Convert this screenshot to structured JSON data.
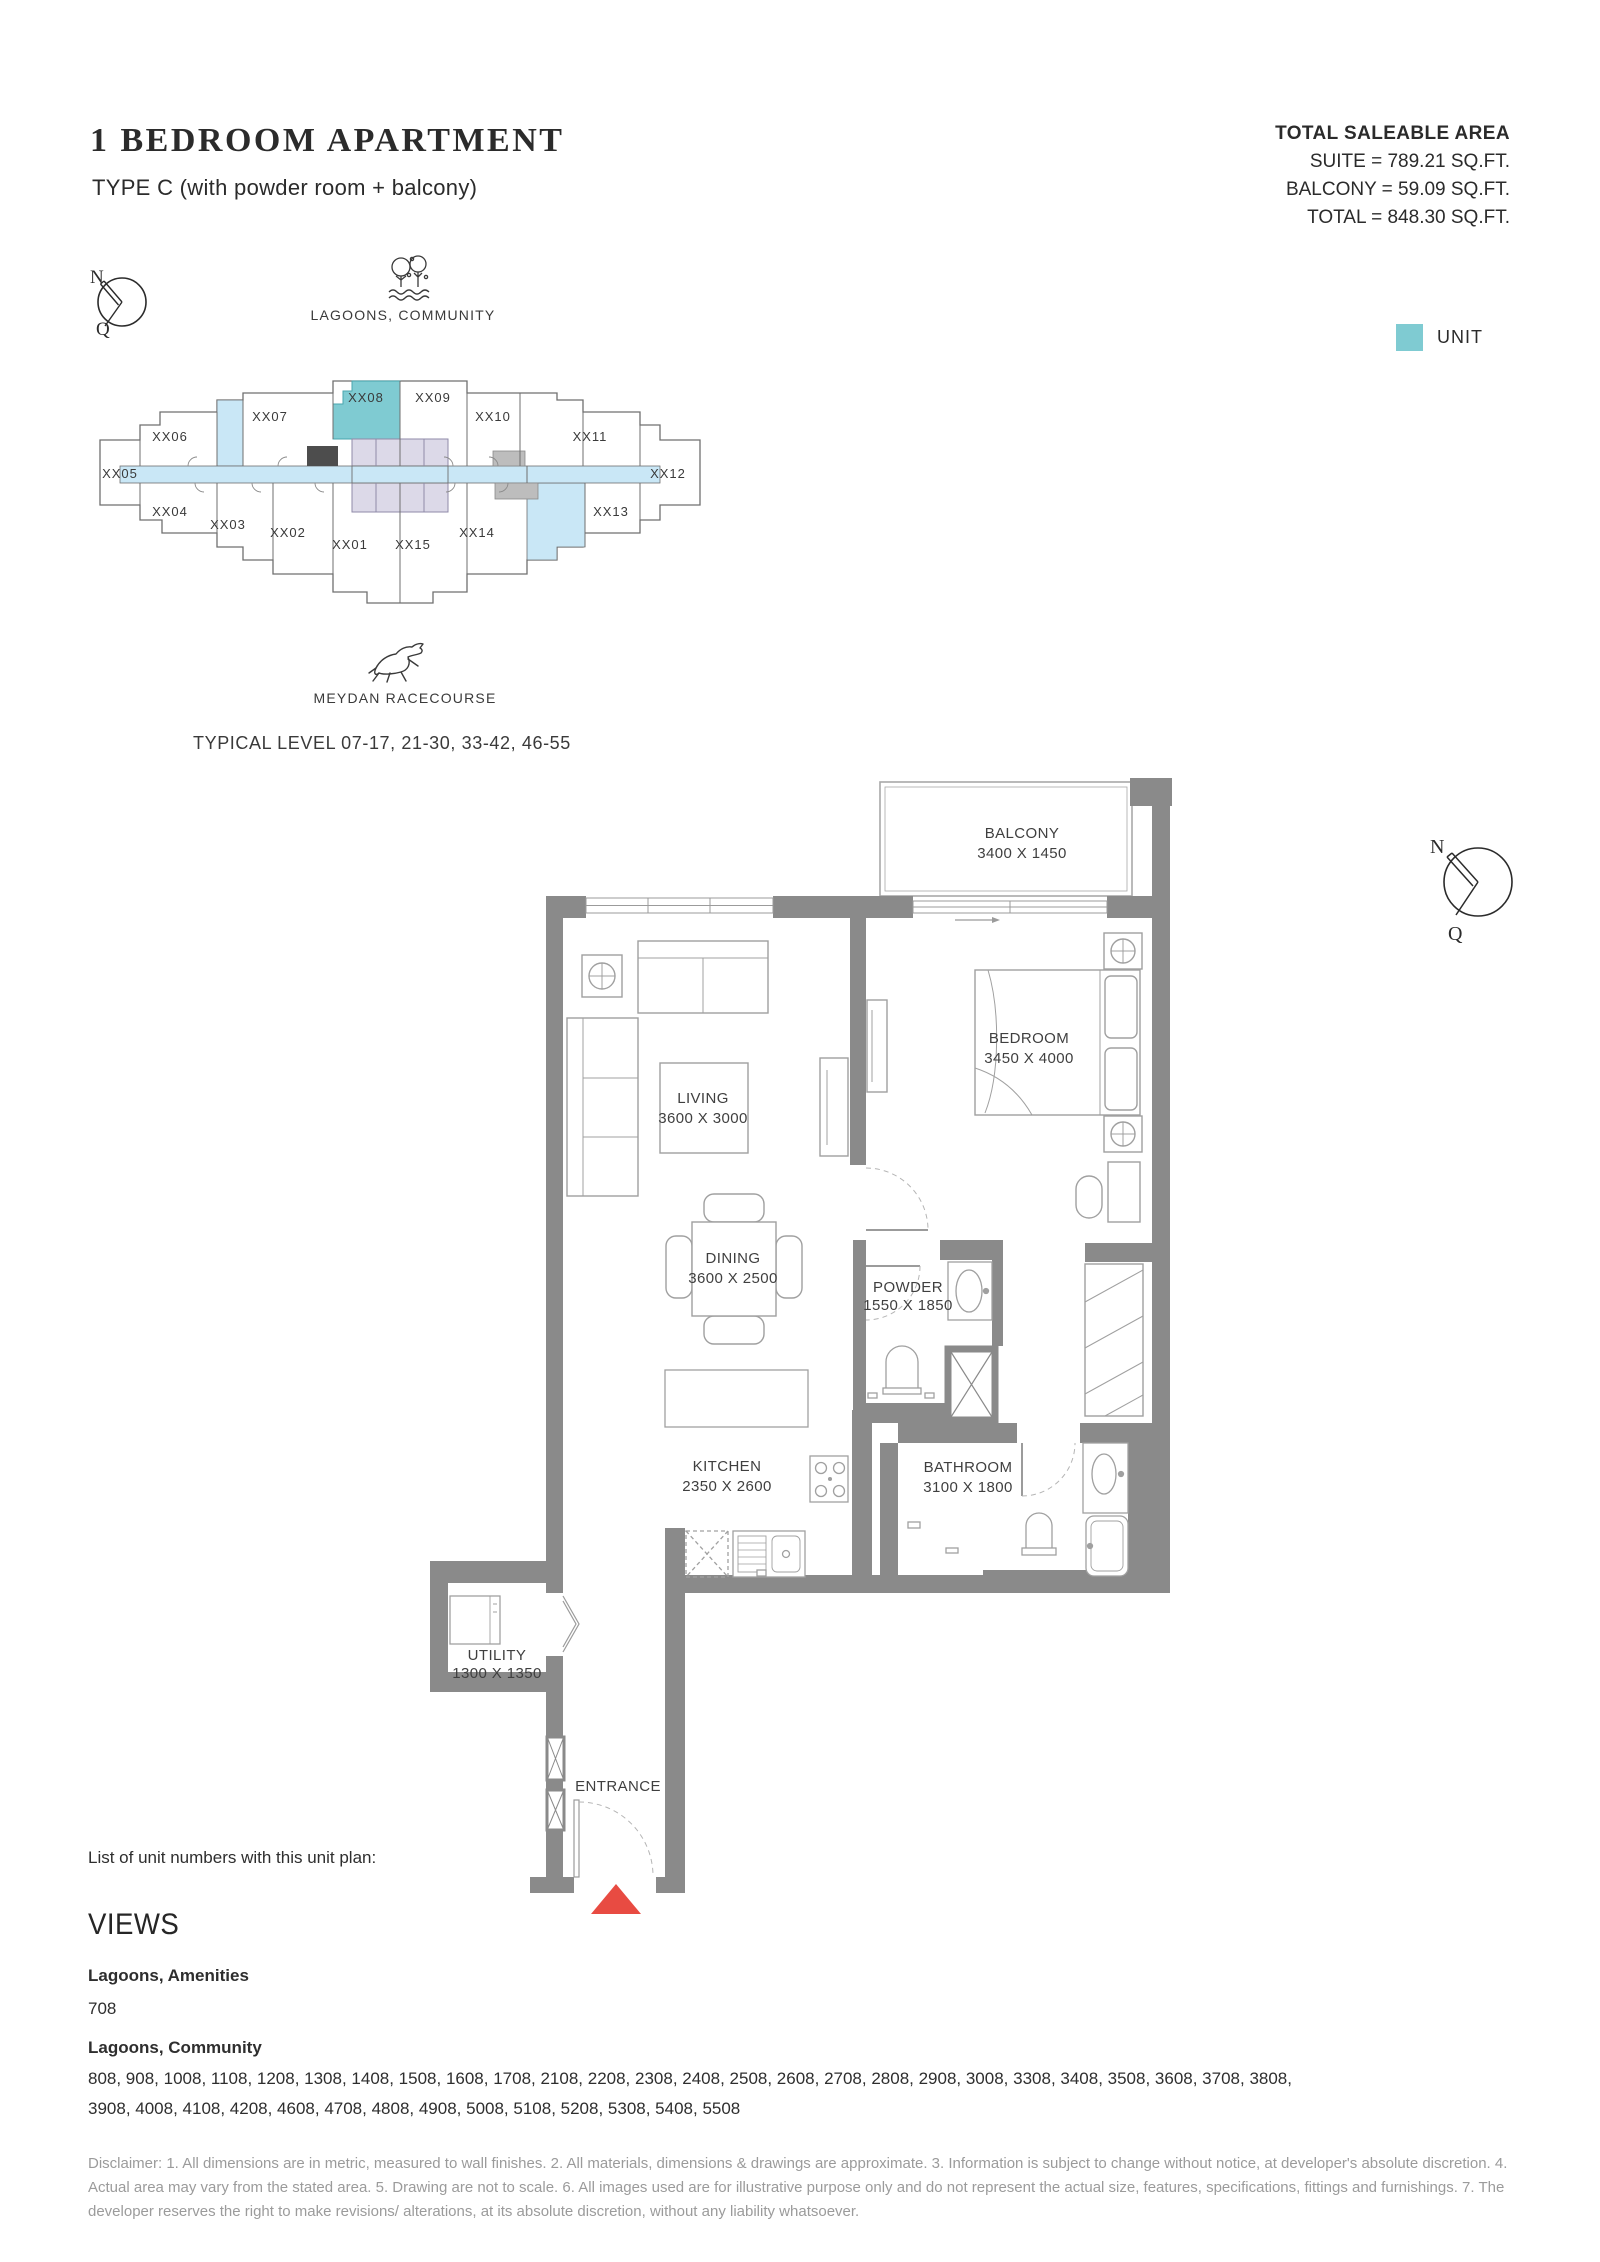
{
  "header": {
    "title": "1 BEDROOM APARTMENT",
    "subtitle": "TYPE C (with powder room + balcony)"
  },
  "area_summary": {
    "heading": "TOTAL SALEABLE AREA",
    "lines": [
      "SUITE = 789.21 SQ.FT.",
      "BALCONY = 59.09 SQ.FT.",
      "TOTAL = 848.30 SQ.FT."
    ]
  },
  "key_plan": {
    "context_top": "LAGOONS, COMMUNITY",
    "context_bottom": "MEYDAN RACECOURSE",
    "level_note": "TYPICAL LEVEL 07-17, 21-30, 33-42, 46-55",
    "legend_label": "UNIT",
    "unit_highlight_color": "#7fcbd2",
    "highlighted_unit": "XX08",
    "units": [
      "XX01",
      "XX02",
      "XX03",
      "XX04",
      "XX05",
      "XX06",
      "XX07",
      "XX08",
      "XX09",
      "XX10",
      "XX11",
      "XX12",
      "XX13",
      "XX14",
      "XX15"
    ]
  },
  "compass": {
    "n": "N",
    "q": "Q"
  },
  "floor_plan": {
    "entrance_label": "ENTRANCE",
    "rooms": [
      {
        "name": "BALCONY",
        "dims": "3400 X 1450"
      },
      {
        "name": "BEDROOM",
        "dims": "3450 X 4000"
      },
      {
        "name": "LIVING",
        "dims": "3600 X 3000"
      },
      {
        "name": "DINING",
        "dims": "3600 X 2500"
      },
      {
        "name": "POWDER",
        "dims": "1550 X 1850"
      },
      {
        "name": "KITCHEN",
        "dims": "2350 X 2600"
      },
      {
        "name": "BATHROOM",
        "dims": "3100 X 1800"
      },
      {
        "name": "UTILITY",
        "dims": "1300 X 1350"
      }
    ]
  },
  "unit_list": {
    "intro": "List of unit numbers with this unit plan:",
    "views_heading": "VIEWS",
    "groups": [
      {
        "view": "Lagoons, Amenities",
        "units": "708"
      },
      {
        "view": "Lagoons, Community",
        "units": "808, 908, 1008, 1108, 1208, 1308, 1408, 1508, 1608, 1708, 2108, 2208, 2308, 2408, 2508, 2608, 2708, 2808, 2908, 3008, 3308, 3408, 3508, 3608, 3708, 3808, 3908, 4008, 4108, 4208, 4608, 4708, 4808, 4908, 5008, 5108, 5208, 5308, 5408, 5508"
      }
    ]
  },
  "disclaimer": "Disclaimer: 1. All dimensions are in metric, measured to wall finishes. 2. All materials, dimensions & drawings are approximate. 3. Information is subject to change without notice, at developer's absolute discretion. 4. Actual area may vary from the stated area. 5. Drawing are not to scale. 6. All images used are for illustrative purpose only and do not represent the actual size, features, specifications, fittings and furnishings. 7. The developer reserves the right to make revisions/ alterations, at its absolute discretion, without any liability whatsoever."
}
